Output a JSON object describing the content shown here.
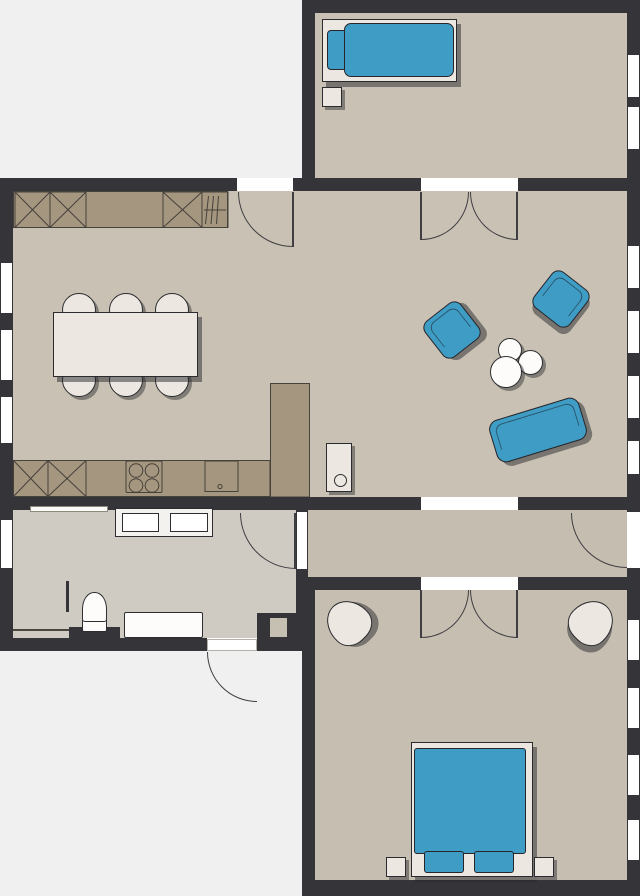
{
  "document_type": "apartment-floor-plan",
  "colors": {
    "background": "#f0f0f0",
    "wall": "#353539",
    "floor_main": "#c9c1b3",
    "floor_top_room": "#c9c1b3",
    "floor_corridor": "#c5bdb0",
    "floor_bath": "#cfcac2",
    "floor_bedroom": "#c6beb1",
    "counter": "#a5967f",
    "counter_line": "#45413b",
    "accent_blue": "#3e9cc5",
    "furniture_cream": "#ece8e1",
    "furniture_outline": "#2c2c30",
    "window_white": "#ffffff",
    "door_line": "#3f3e42"
  },
  "rooms": [
    {
      "id": "bedroom-top-right",
      "windows": 2,
      "furniture": [
        "single-bed",
        "single-bed-pillow",
        "nightstand"
      ]
    },
    {
      "id": "kitchen-dining",
      "windows": 3,
      "furniture": [
        "dining-table",
        "dining-chair (x6)",
        "kitchen-counter-top",
        "kitchen-counter-bottom",
        "peninsula-counter",
        "stove",
        "kitchen-sink",
        "dish-rack",
        "cabinet-with-cross (x5)"
      ]
    },
    {
      "id": "living-room",
      "windows": 4,
      "furniture": [
        "armchair (x2)",
        "sofa",
        "round-coffee-table (x3)",
        "side-cabinet"
      ]
    },
    {
      "id": "corridor",
      "windows": 0,
      "furniture": []
    },
    {
      "id": "bathroom-hall",
      "windows": 1,
      "furniture": [
        "washer-dryer-unit",
        "wall-shelf",
        "toilet",
        "bathtub",
        "shower-partition"
      ]
    },
    {
      "id": "bedroom-bottom-right",
      "windows": 4,
      "furniture": [
        "double-bed",
        "bed-pillow (x2)",
        "nightstand (x2)",
        "corner-armchair (x2)"
      ]
    }
  ],
  "doors": [
    "kitchen-exterior-door",
    "double-door-topbedroom-living",
    "opening-living-corridor",
    "double-door-corridor-bedroom",
    "door-hall-corridor",
    "corridor-exterior-door",
    "entrance-door"
  ]
}
